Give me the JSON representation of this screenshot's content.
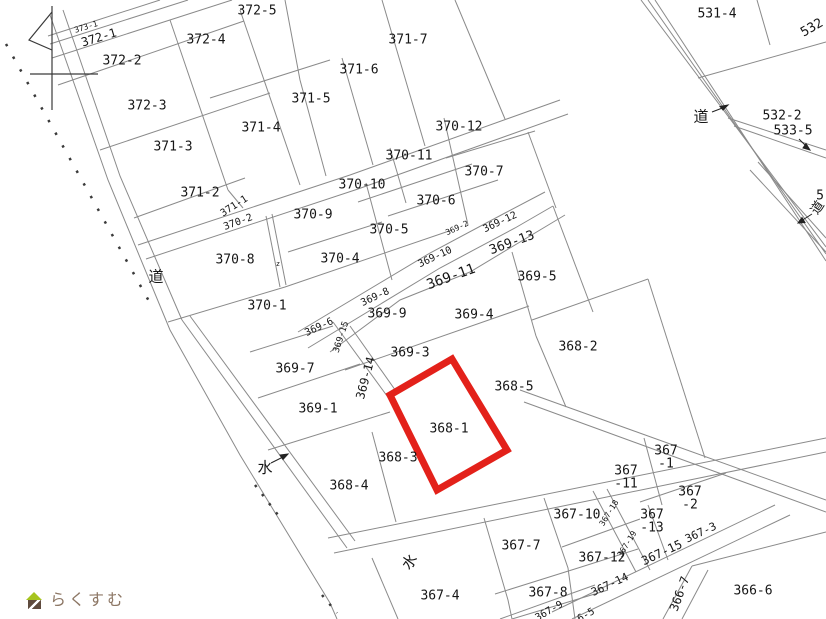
{
  "map": {
    "title": "cadastral-parcel-map",
    "highlighted_parcel": {
      "id": "368-1",
      "color": "#e3211a"
    },
    "line_color": "#8a8a8a",
    "watermark": {
      "text": "らくすむ",
      "icon": "house-icon",
      "text_color": "#8d7765",
      "roof_color": "#a6c41f",
      "body_color": "#5f4b3e"
    },
    "legend": {
      "road": "道",
      "water": "水"
    },
    "labels": [
      {
        "text": "373-1",
        "x": 86,
        "y": 27,
        "rot": -17,
        "size": 8,
        "kind": "parcel-small"
      },
      {
        "text": "372-1",
        "x": 99,
        "y": 38,
        "rot": -17,
        "size": 12,
        "kind": "parcel"
      },
      {
        "text": "372-2",
        "x": 122,
        "y": 61,
        "size": 13,
        "kind": "parcel"
      },
      {
        "text": "372-4",
        "x": 206,
        "y": 40,
        "size": 13,
        "kind": "parcel"
      },
      {
        "text": "372-5",
        "x": 257,
        "y": 11,
        "size": 13,
        "kind": "parcel"
      },
      {
        "text": "372-3",
        "x": 147,
        "y": 106,
        "size": 13,
        "kind": "parcel"
      },
      {
        "text": "371-3",
        "x": 173,
        "y": 147,
        "size": 13,
        "kind": "parcel"
      },
      {
        "text": "371-4",
        "x": 261,
        "y": 128,
        "size": 13,
        "kind": "parcel"
      },
      {
        "text": "371-2",
        "x": 200,
        "y": 193,
        "size": 13,
        "kind": "parcel"
      },
      {
        "text": "371-1",
        "x": 234,
        "y": 206,
        "rot": -33,
        "size": 10,
        "kind": "parcel"
      },
      {
        "text": "370-2",
        "x": 238,
        "y": 222,
        "rot": -20,
        "size": 10,
        "kind": "parcel"
      },
      {
        "text": "371-5",
        "x": 311,
        "y": 99,
        "size": 13,
        "kind": "parcel"
      },
      {
        "text": "371-6",
        "x": 359,
        "y": 70,
        "size": 13,
        "kind": "parcel"
      },
      {
        "text": "371-7",
        "x": 408,
        "y": 40,
        "size": 13,
        "kind": "parcel"
      },
      {
        "text": "370-12",
        "x": 459,
        "y": 127,
        "size": 13,
        "kind": "parcel"
      },
      {
        "text": "370-11",
        "x": 409,
        "y": 156,
        "size": 13,
        "kind": "parcel"
      },
      {
        "text": "370-10",
        "x": 362,
        "y": 185,
        "size": 13,
        "kind": "parcel"
      },
      {
        "text": "370-7",
        "x": 484,
        "y": 172,
        "size": 13,
        "kind": "parcel"
      },
      {
        "text": "370-6",
        "x": 436,
        "y": 201,
        "size": 13,
        "kind": "parcel"
      },
      {
        "text": "370-9",
        "x": 313,
        "y": 215,
        "size": 13,
        "kind": "parcel"
      },
      {
        "text": "370-5",
        "x": 389,
        "y": 230,
        "size": 13,
        "kind": "parcel"
      },
      {
        "text": "370-8",
        "x": 235,
        "y": 260,
        "size": 13,
        "kind": "parcel"
      },
      {
        "text": "370-4",
        "x": 340,
        "y": 259,
        "size": 13,
        "kind": "parcel"
      },
      {
        "text": "370-1",
        "x": 267,
        "y": 306,
        "size": 13,
        "kind": "parcel"
      },
      {
        "text": "369-2",
        "x": 457,
        "y": 228,
        "rot": -25,
        "size": 8,
        "kind": "parcel-small"
      },
      {
        "text": "369-12",
        "x": 500,
        "y": 222,
        "rot": -25,
        "size": 10,
        "kind": "parcel"
      },
      {
        "text": "369-13",
        "x": 512,
        "y": 243,
        "rot": -20,
        "size": 13,
        "kind": "parcel"
      },
      {
        "text": "369-10",
        "x": 435,
        "y": 257,
        "rot": -25,
        "size": 10,
        "kind": "parcel"
      },
      {
        "text": "369-11",
        "x": 451,
        "y": 277,
        "rot": -20,
        "size": 14,
        "kind": "parcel"
      },
      {
        "text": "369-5",
        "x": 537,
        "y": 277,
        "size": 13,
        "kind": "parcel"
      },
      {
        "text": "369-8",
        "x": 375,
        "y": 297,
        "rot": -25,
        "size": 10,
        "kind": "parcel"
      },
      {
        "text": "369-9",
        "x": 387,
        "y": 314,
        "size": 13,
        "kind": "parcel"
      },
      {
        "text": "369-4",
        "x": 474,
        "y": 315,
        "size": 13,
        "kind": "parcel"
      },
      {
        "text": "369-6",
        "x": 319,
        "y": 327,
        "rot": -25,
        "size": 10,
        "kind": "parcel"
      },
      {
        "text": "369-15",
        "x": 341,
        "y": 337,
        "rot": -72,
        "size": 9,
        "kind": "parcel-small"
      },
      {
        "text": "369-3",
        "x": 410,
        "y": 353,
        "size": 13,
        "kind": "parcel"
      },
      {
        "text": "368-2",
        "x": 578,
        "y": 347,
        "size": 13,
        "kind": "parcel"
      },
      {
        "text": "369-7",
        "x": 295,
        "y": 369,
        "size": 13,
        "kind": "parcel"
      },
      {
        "text": "369-14",
        "x": 366,
        "y": 378,
        "rot": -75,
        "size": 12,
        "kind": "parcel"
      },
      {
        "text": "368-5",
        "x": 514,
        "y": 387,
        "size": 13,
        "kind": "parcel"
      },
      {
        "text": "369-1",
        "x": 318,
        "y": 409,
        "size": 13,
        "kind": "parcel"
      },
      {
        "text": "368-1",
        "x": 449,
        "y": 429,
        "size": 13,
        "kind": "parcel-highlighted"
      },
      {
        "text": "368-3",
        "x": 398,
        "y": 458,
        "size": 13,
        "kind": "parcel"
      },
      {
        "text": "368-4",
        "x": 349,
        "y": 486,
        "size": 13,
        "kind": "parcel"
      },
      {
        "lines": [
          "367",
          "-1"
        ],
        "x": 666,
        "y": 457,
        "size": 13,
        "kind": "parcel"
      },
      {
        "lines": [
          "367",
          "-11"
        ],
        "x": 626,
        "y": 477,
        "size": 13,
        "kind": "parcel"
      },
      {
        "text": "367-10",
        "x": 577,
        "y": 515,
        "size": 13,
        "kind": "parcel"
      },
      {
        "text": "367-18",
        "x": 609,
        "y": 513,
        "rot": -58,
        "size": 8,
        "kind": "parcel-small"
      },
      {
        "lines": [
          "367",
          "-2"
        ],
        "x": 690,
        "y": 498,
        "size": 13,
        "kind": "parcel"
      },
      {
        "lines": [
          "367",
          "-13"
        ],
        "x": 652,
        "y": 521,
        "size": 13,
        "kind": "parcel"
      },
      {
        "text": "367-3",
        "x": 701,
        "y": 533,
        "rot": -25,
        "size": 11,
        "kind": "parcel"
      },
      {
        "text": "367-19",
        "x": 627,
        "y": 544,
        "rot": -58,
        "size": 8,
        "kind": "parcel-small"
      },
      {
        "text": "367-15",
        "x": 662,
        "y": 553,
        "rot": -25,
        "size": 12,
        "kind": "parcel"
      },
      {
        "text": "367-12",
        "x": 602,
        "y": 558,
        "size": 13,
        "kind": "parcel"
      },
      {
        "text": "367-7",
        "x": 521,
        "y": 546,
        "size": 13,
        "kind": "parcel"
      },
      {
        "text": "367-14",
        "x": 610,
        "y": 585,
        "rot": -25,
        "size": 11,
        "kind": "parcel"
      },
      {
        "text": "367-4",
        "x": 440,
        "y": 596,
        "size": 13,
        "kind": "parcel"
      },
      {
        "text": "367-8",
        "x": 548,
        "y": 593,
        "size": 13,
        "kind": "parcel"
      },
      {
        "text": "367-9",
        "x": 549,
        "y": 611,
        "rot": -30,
        "size": 10,
        "kind": "parcel"
      },
      {
        "text": "6-5",
        "x": 586,
        "y": 615,
        "rot": -30,
        "size": 10,
        "kind": "parcel-partial"
      },
      {
        "text": "366-7",
        "x": 680,
        "y": 594,
        "rot": -70,
        "size": 12,
        "kind": "parcel"
      },
      {
        "text": "366-6",
        "x": 753,
        "y": 591,
        "size": 13,
        "kind": "parcel"
      },
      {
        "text": "531-4",
        "x": 717,
        "y": 14,
        "size": 13,
        "kind": "parcel"
      },
      {
        "text": "532",
        "x": 812,
        "y": 28,
        "rot": -30,
        "size": 13,
        "kind": "parcel-partial"
      },
      {
        "text": "532-2",
        "x": 782,
        "y": 116,
        "size": 13,
        "kind": "parcel"
      },
      {
        "text": "533-5",
        "x": 793,
        "y": 131,
        "size": 13,
        "kind": "parcel"
      },
      {
        "text": "5",
        "x": 820,
        "y": 196,
        "size": 13,
        "kind": "parcel-partial"
      },
      {
        "text": "道",
        "x": 701,
        "y": 117,
        "size": 15,
        "kind": "road"
      },
      {
        "text": "道",
        "x": 818,
        "y": 208,
        "rot": -55,
        "size": 13,
        "kind": "road"
      },
      {
        "text": "道",
        "x": 156,
        "y": 277,
        "size": 15,
        "kind": "road"
      },
      {
        "text": "水",
        "x": 265,
        "y": 468,
        "size": 15,
        "kind": "water"
      },
      {
        "text": "水",
        "x": 410,
        "y": 562,
        "rot": -55,
        "size": 15,
        "kind": "water"
      },
      {
        "text": "z",
        "x": 278,
        "y": 264,
        "size": 7,
        "kind": "survey-mark"
      }
    ]
  }
}
